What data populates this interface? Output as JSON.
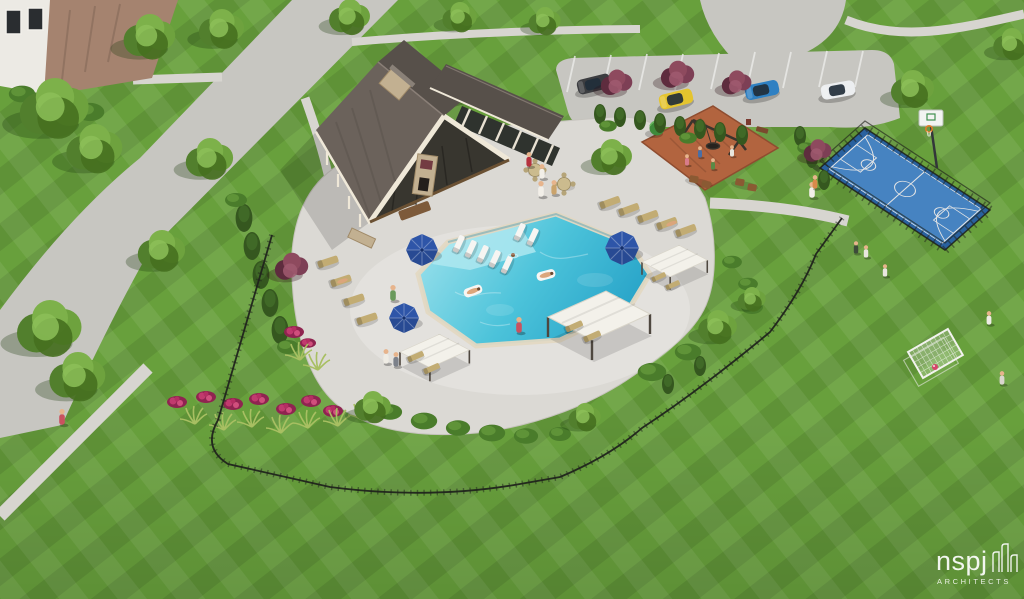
{
  "scene": {
    "label": "Aerial architectural rendering of a community amenity center",
    "features": [
      "clubhouse",
      "resort pool with tanning ledge",
      "pool deck",
      "cabanas",
      "blue umbrellas",
      "chaise lounges",
      "playground with swing set",
      "basketball court",
      "soccer goal",
      "parking lot with cars",
      "iron fence",
      "landscaped gardens",
      "striped lawn",
      "walking paths"
    ]
  },
  "watermark": {
    "brand": "nspj",
    "subtitle": "ARCHITECTS"
  },
  "colors": {
    "grass": "#68a03c",
    "road": "#c7c6c1",
    "sidewalk": "#d7d5d0",
    "pool_deck": "#dbd9d4",
    "coping": "#e3d8c2",
    "pool_light": "#93deea",
    "pool_mid": "#4cc3da",
    "pool_deep": "#1f9cc4",
    "roof": "#6b625b",
    "roof_dark": "#57504a",
    "trim": "#efe8d8",
    "stone": "#c2b091",
    "timber": "#6b5133",
    "court_blue": "#4e92d6",
    "court_border": "#2e6cb0",
    "court_line": "#ffffff",
    "mulch": "#b2643f",
    "umbrella": "#2e55a8",
    "canopy": "#f3f1ea",
    "chaise": "#c2ac73",
    "lounger_white": "#f6f5f2",
    "fence": "#20241c",
    "tree_green": "#5d8f33",
    "tree_purple": "#7d3f55",
    "flower": "#b52e62",
    "house_roof": "#a5836f",
    "house_wall": "#eceae4",
    "car_dark": "#3c3d40",
    "car_yellow": "#e4c42e",
    "car_blue": "#2f80c2",
    "car_white": "#eceef0",
    "car_red": "#8e2f35",
    "watermark": "#ffffff"
  }
}
